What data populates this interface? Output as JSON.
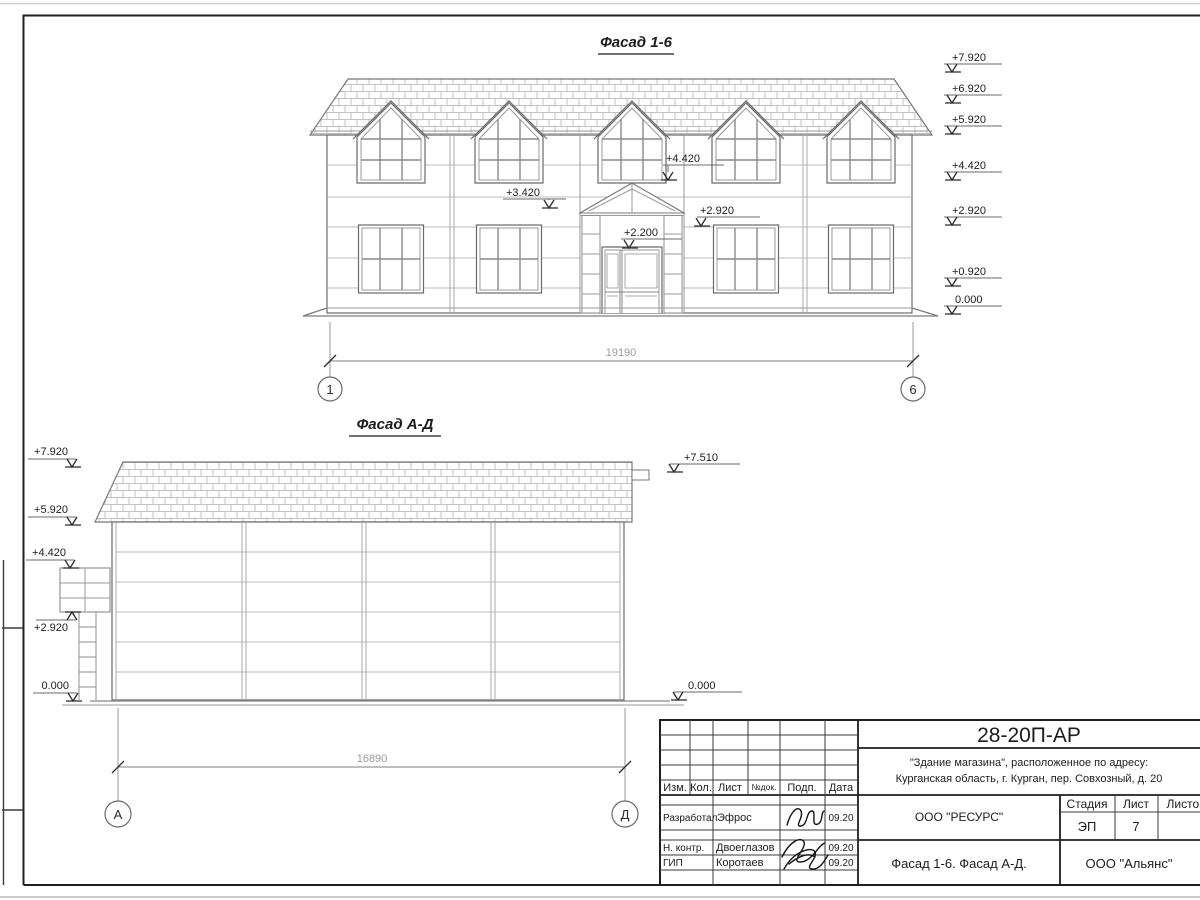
{
  "colors": {
    "paper": "#ffffff",
    "line_dark": "#1f1f1f",
    "line_medium": "#6a6a6a",
    "line_light": "#bdbdbd",
    "dim_text": "#9a9a9a",
    "shingle": "#c2c2c2"
  },
  "facade16": {
    "title": "Фасад 1-6",
    "marks_right": [
      "+7.920",
      "+6.920",
      "+5.920",
      "+4.420",
      "+2.920",
      "+0.920",
      "0.000"
    ],
    "marks_inner": [
      "+4.420",
      "+3.420",
      "+2.920",
      "+2.200"
    ],
    "dimension": "19190",
    "axis_left": "1",
    "axis_right": "6"
  },
  "facadeAD": {
    "title": "Фасад А-Д",
    "marks_left": [
      "+7.920",
      "+5.920",
      "+4.420",
      "+2.920",
      "0.000"
    ],
    "marks_right": [
      "+7.510",
      "0.000"
    ],
    "dimension": "16890",
    "axis_left": "А",
    "axis_right": "Д"
  },
  "titleblock": {
    "doc_number": "28-20П-АР",
    "object_line1": "\"Здание магазина\", расположенное по адресу:",
    "object_line2": "Курганская область, г. Курган, пер. Совхозный, д. 20",
    "designer_org": "ООО \"РЕСУРС\"",
    "sheet_title": "Фасад 1-6. Фасад А-Д.",
    "customer_org": "ООО \"Альянс\"",
    "stage_label": "Стадия",
    "sheet_label": "Лист",
    "sheets_label": "Листов",
    "stage_value": "ЭП",
    "sheet_value": "7",
    "col_izm": "Изм.",
    "col_kol": "Кол.",
    "col_list": "Лист",
    "col_ndok": "№док.",
    "col_podp": "Подп.",
    "col_data": "Дата",
    "roles": [
      {
        "role": "Разработал",
        "name": "Эфрос",
        "date": "09.20"
      },
      {
        "role": "Н. контр.",
        "name": "Двоеглазов",
        "date": "09.20"
      },
      {
        "role": "ГИП",
        "name": "Коротаев",
        "date": "09.20"
      }
    ]
  }
}
